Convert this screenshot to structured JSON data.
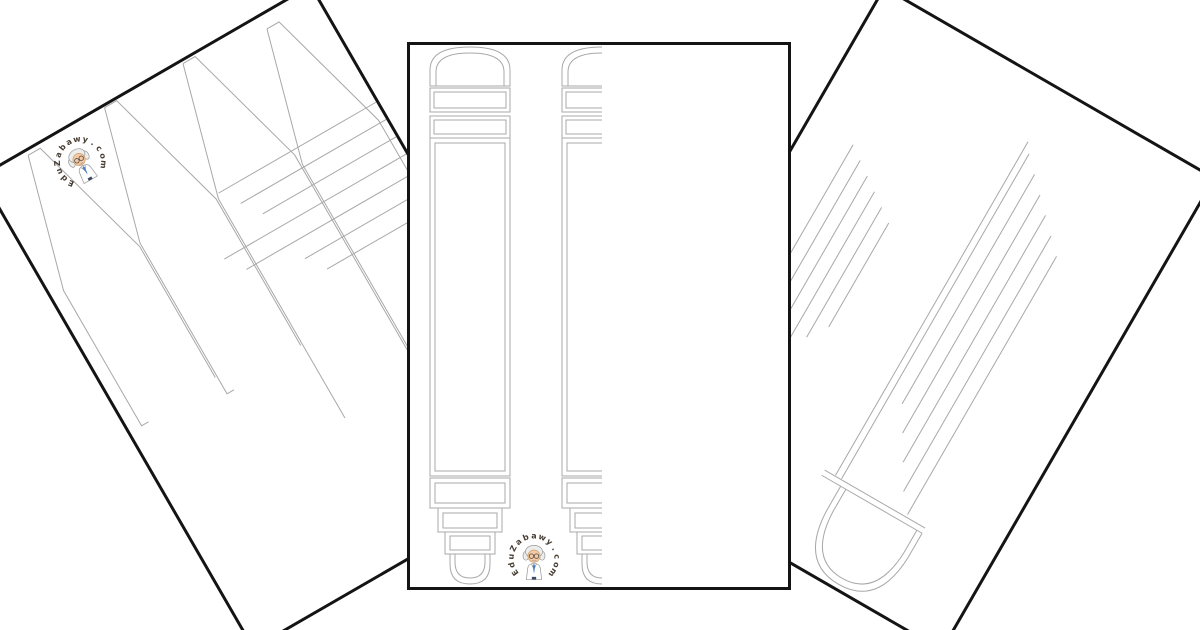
{
  "canvas": {
    "width": 1200,
    "height": 630,
    "background": "#ffffff"
  },
  "branding": {
    "logo_text": "EduZabawy.com",
    "logo_text_color": "#473d33",
    "mascot": {
      "hair": "#ededed",
      "face": "#f6c9a2",
      "face_outline": "#c9a06e",
      "coat": "#ffffff",
      "tie": "#4a7fc1",
      "outline": "#999999",
      "glasses": "#4a4a4a",
      "pants": "#3c4a63"
    }
  },
  "artwork": {
    "stroke": "#a8a8a8",
    "page_border": "#141414",
    "page_background": "#ffffff"
  },
  "pages": {
    "left": {
      "name": "crayons-outline-worksheet"
    },
    "center": {
      "name": "markers-outline-worksheet"
    },
    "right": {
      "name": "large-marker-outline-worksheet"
    }
  }
}
